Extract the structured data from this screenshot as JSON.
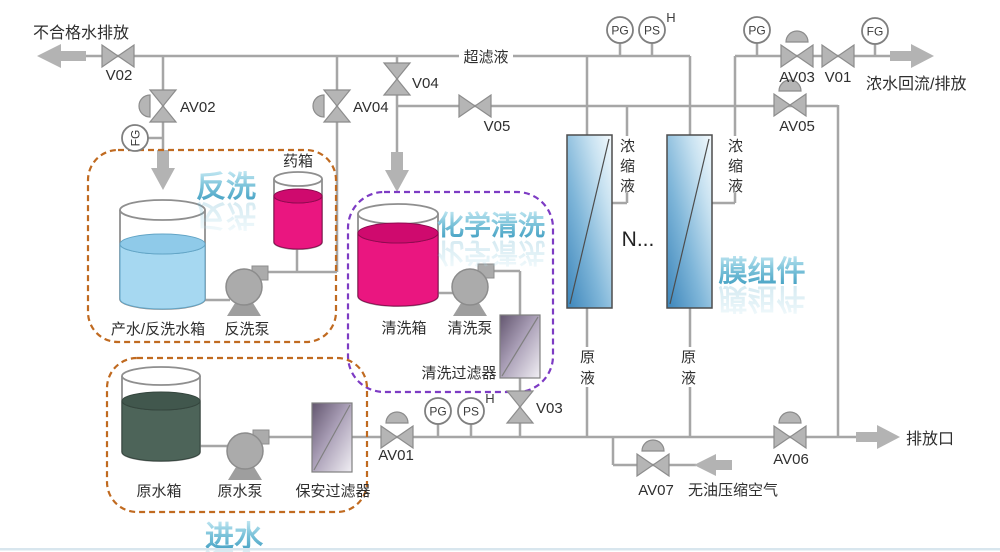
{
  "diagram": {
    "flows": {
      "offspec": "不合格水排放",
      "permeate": "超滤液",
      "concentrate_return": "浓水回流/排放",
      "drain_outlet": "排放口",
      "oil_free_air": "无油压缩空气"
    },
    "regions": {
      "backwash": "反洗",
      "chemical_cleaning": "化学清洗",
      "feed": "进水",
      "membranes": "膜组件"
    },
    "valves": {
      "v01": "V01",
      "v02": "V02",
      "v03": "V03",
      "v04": "V04",
      "v05": "V05",
      "av01": "AV01",
      "av02": "AV02",
      "av03": "AV03",
      "av04": "AV04",
      "av05": "AV05",
      "av06": "AV06",
      "av07": "AV07"
    },
    "instruments": {
      "pg": "PG",
      "ps": "PS",
      "fg": "FG",
      "high": "H"
    },
    "equipment": {
      "dosing_tank": "药箱",
      "backwash_tank": "产水/反洗水箱",
      "backwash_pump": "反洗泵",
      "cleaning_tank": "清洗箱",
      "cleaning_pump": "清洗泵",
      "cleaning_filter": "清洗过滤器",
      "raw_water_tank": "原水箱",
      "raw_water_pump": "原水泵",
      "security_filter": "保安过滤器"
    },
    "streams": {
      "concentrate": [
        "浓",
        "缩",
        "液"
      ],
      "raw_feed": [
        "原",
        "液"
      ],
      "more_modules": "N..."
    },
    "colors": {
      "pipe": "#a6a6a6",
      "valve_gray": "#b5b5b5",
      "region_orange": "#c06a20",
      "region_purple": "#7d3bc4",
      "title_blue": "#4aa3c6",
      "water_blue": "#a6d8f1",
      "chemical_pink": "#ea1680",
      "raw_water_green": "#4d6459",
      "membrane_blue": "#3c85ba",
      "filter_purple": "#63566f"
    }
  }
}
